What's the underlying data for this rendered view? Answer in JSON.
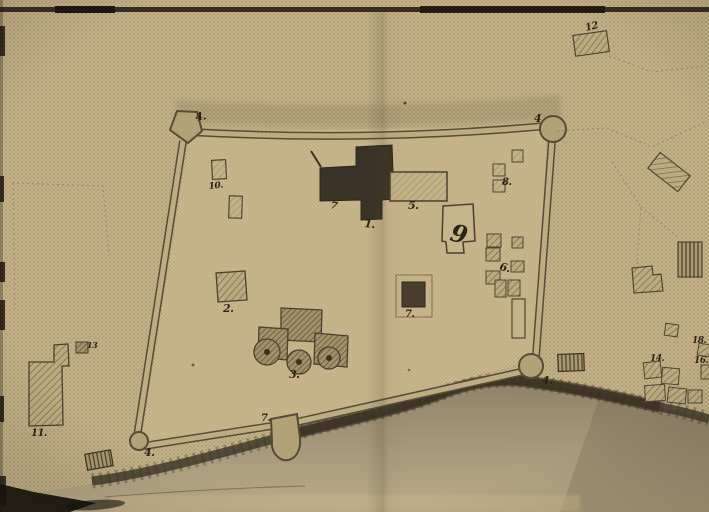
{
  "meta": {
    "artifact": "halftone sepia scan of a hand-drawn fortress plan with numbered structures"
  },
  "palette": {
    "paper": "#c9b68d",
    "paper_dot": "#8c7855",
    "wall_dark": "#584c38",
    "wall_light": "#bead83",
    "building_dark": "#3a3226",
    "building_outline": "#4a4030",
    "hatch_bg": "#bcab80",
    "hatch_line": "#76664a",
    "water": "#a3957b",
    "shore": "#3b3327",
    "ink": "#2b2415",
    "boundary_dash": "#8a7a5b"
  },
  "map": {
    "annotations": [
      {
        "id": "bastion-top-left",
        "text": "4.",
        "x": 196,
        "y": 121,
        "size": 11,
        "rotate": -10
      },
      {
        "id": "bastion-top-right",
        "text": "4",
        "x": 534,
        "y": 122,
        "size": 11,
        "rotate": 0
      },
      {
        "id": "bastion-bottom-right",
        "text": "4.",
        "x": 542,
        "y": 384,
        "size": 11,
        "rotate": 0
      },
      {
        "id": "bastion-bottom-left",
        "text": "4.",
        "x": 144,
        "y": 456,
        "size": 11,
        "rotate": 0
      },
      {
        "id": "building-10",
        "text": "10.",
        "x": 209,
        "y": 189,
        "size": 9,
        "rotate": -6
      },
      {
        "id": "building-2",
        "text": "2.",
        "x": 223,
        "y": 312,
        "size": 11,
        "rotate": 0
      },
      {
        "id": "building-3",
        "text": "3.",
        "x": 289,
        "y": 378,
        "size": 11,
        "rotate": 0
      },
      {
        "id": "building-annex",
        "text": "7",
        "x": 330,
        "y": 208,
        "size": 10,
        "rotate": 12
      },
      {
        "id": "building-1",
        "text": "1.",
        "x": 364,
        "y": 227,
        "size": 11,
        "rotate": 6
      },
      {
        "id": "building-5",
        "text": "5.",
        "x": 408,
        "y": 209,
        "size": 11,
        "rotate": 0
      },
      {
        "id": "building-9",
        "text": "9",
        "x": 449,
        "y": 240,
        "size": 24,
        "rotate": 14
      },
      {
        "id": "building-8",
        "text": "8.",
        "x": 502,
        "y": 185,
        "size": 10,
        "rotate": 0
      },
      {
        "id": "building-6",
        "text": "6.",
        "x": 499,
        "y": 270,
        "size": 11,
        "rotate": 12
      },
      {
        "id": "building-7",
        "text": "7.",
        "x": 405,
        "y": 317,
        "size": 10,
        "rotate": 0
      },
      {
        "id": "gate-tower",
        "text": "7.",
        "x": 261,
        "y": 421,
        "size": 10,
        "rotate": 0
      },
      {
        "id": "building-12",
        "text": "12",
        "x": 586,
        "y": 31,
        "size": 10,
        "rotate": -14
      },
      {
        "id": "building-11",
        "text": "11.",
        "x": 31,
        "y": 436,
        "size": 10,
        "rotate": 0
      },
      {
        "id": "building-13",
        "text": "13",
        "x": 87,
        "y": 348,
        "size": 8,
        "rotate": 0
      },
      {
        "id": "building-14",
        "text": "14.",
        "x": 650,
        "y": 361,
        "size": 9,
        "rotate": 0
      },
      {
        "id": "building-18",
        "text": "18.",
        "x": 692,
        "y": 343,
        "size": 9,
        "rotate": 0
      },
      {
        "id": "building-16",
        "text": "16.",
        "x": 694,
        "y": 363,
        "size": 9,
        "rotate": 0
      }
    ]
  }
}
